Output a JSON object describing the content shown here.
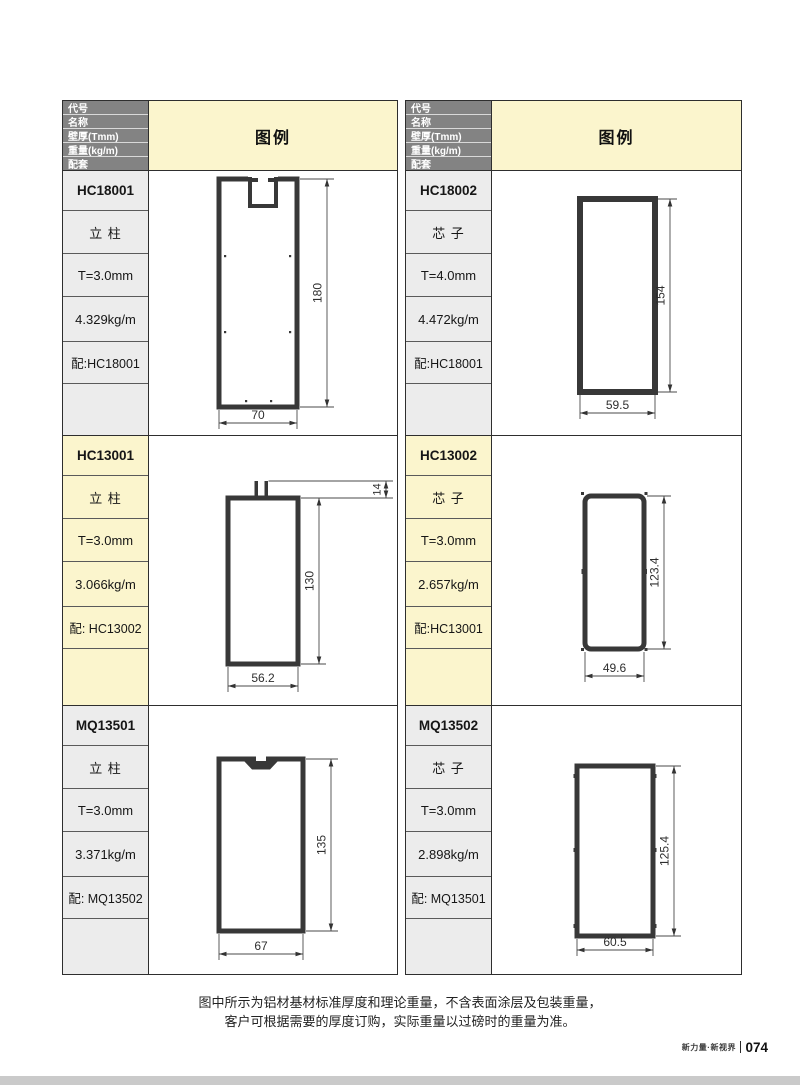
{
  "page": {
    "note_line1": "图中所示为铝材基材标准厚度和理论重量，不含表面涂层及包装重量，",
    "note_line2": "客户可根据需要的厚度订购，实际重量以过磅时的重量为准。",
    "footer": {
      "brand": "新力量·新视界",
      "page_no": "074"
    }
  },
  "table_header": {
    "row_labels": [
      "代号",
      "名称",
      "壁厚(Tmm)",
      "重量(kg/m)",
      "配套"
    ],
    "legend_label": "图例"
  },
  "colors": {
    "header_gray": "#838383",
    "highlight_yellow": "#FBF5CD",
    "cell_gray": "#ECECEC",
    "drawing_stroke": "#383838",
    "footer_bar_gray": "#cacaca"
  },
  "columns": [
    {
      "products": [
        {
          "code": "HC18001",
          "name": "立 柱",
          "thickness": "T=3.0mm",
          "weight": "4.329kg/m",
          "match": "配:HC18001",
          "diagram": {
            "feature": "u-notch-top",
            "height_label": "180",
            "width_label": "70"
          }
        },
        {
          "code": "HC13001",
          "name": "立 柱",
          "thickness": "T=3.0mm",
          "weight": "3.066kg/m",
          "match": "配: HC13002",
          "diagram": {
            "feature": "twin-prongs-top",
            "height_label": "130",
            "width_label": "56.2",
            "top_label": "14"
          }
        },
        {
          "code": "MQ13501",
          "name": "立 柱",
          "thickness": "T=3.0mm",
          "weight": "3.371kg/m",
          "match": "配: MQ13502",
          "diagram": {
            "feature": "v-notch-top",
            "height_label": "135",
            "width_label": "67"
          }
        }
      ]
    },
    {
      "products": [
        {
          "code": "HC18002",
          "name": "芯 子",
          "thickness": "T=4.0mm",
          "weight": "4.472kg/m",
          "match": "配:HC18001",
          "diagram": {
            "feature": "plain-rect",
            "height_label": "154",
            "width_label": "59.5"
          }
        },
        {
          "code": "HC13002",
          "name": "芯 子",
          "thickness": "T=3.0mm",
          "weight": "2.657kg/m",
          "match": "配:HC13001",
          "diagram": {
            "feature": "rounded-rect",
            "height_label": "123.4",
            "width_label": "49.6"
          }
        },
        {
          "code": "MQ13502",
          "name": "芯 子",
          "thickness": "T=3.0mm",
          "weight": "2.898kg/m",
          "match": "配: MQ13501",
          "diagram": {
            "feature": "plain-rect-ticks",
            "height_label": "125.4",
            "width_label": "60.5"
          }
        }
      ]
    }
  ]
}
